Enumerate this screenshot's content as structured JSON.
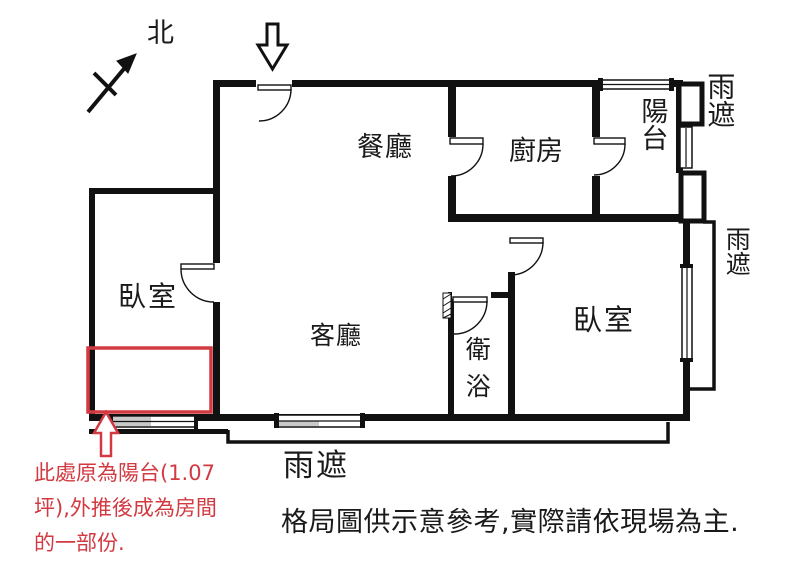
{
  "compass": {
    "label": "北"
  },
  "rooms": {
    "dining": {
      "label": "餐廳"
    },
    "kitchen": {
      "label": "廚房"
    },
    "balcony": {
      "label": "陽台"
    },
    "living": {
      "label": "客廳"
    },
    "bedroom_left": {
      "label": "臥室"
    },
    "bedroom_right": {
      "label": "臥室"
    },
    "bathroom": {
      "label": "衛浴"
    }
  },
  "canopy": {
    "top_right": "雨遮",
    "right": "雨遮",
    "bottom": "雨遮"
  },
  "annotation": {
    "color": "#d23a42",
    "lines": [
      "此處原為陽台(1.07",
      "坪),外推後成為房間",
      "的一部份."
    ]
  },
  "disclaimer": "格局圖供示意參考,實際請依現場為主.",
  "colors": {
    "wall": "#111111",
    "annotation_red": "#d23a42",
    "window_shade": "#c9c9c9",
    "background": "#ffffff"
  }
}
